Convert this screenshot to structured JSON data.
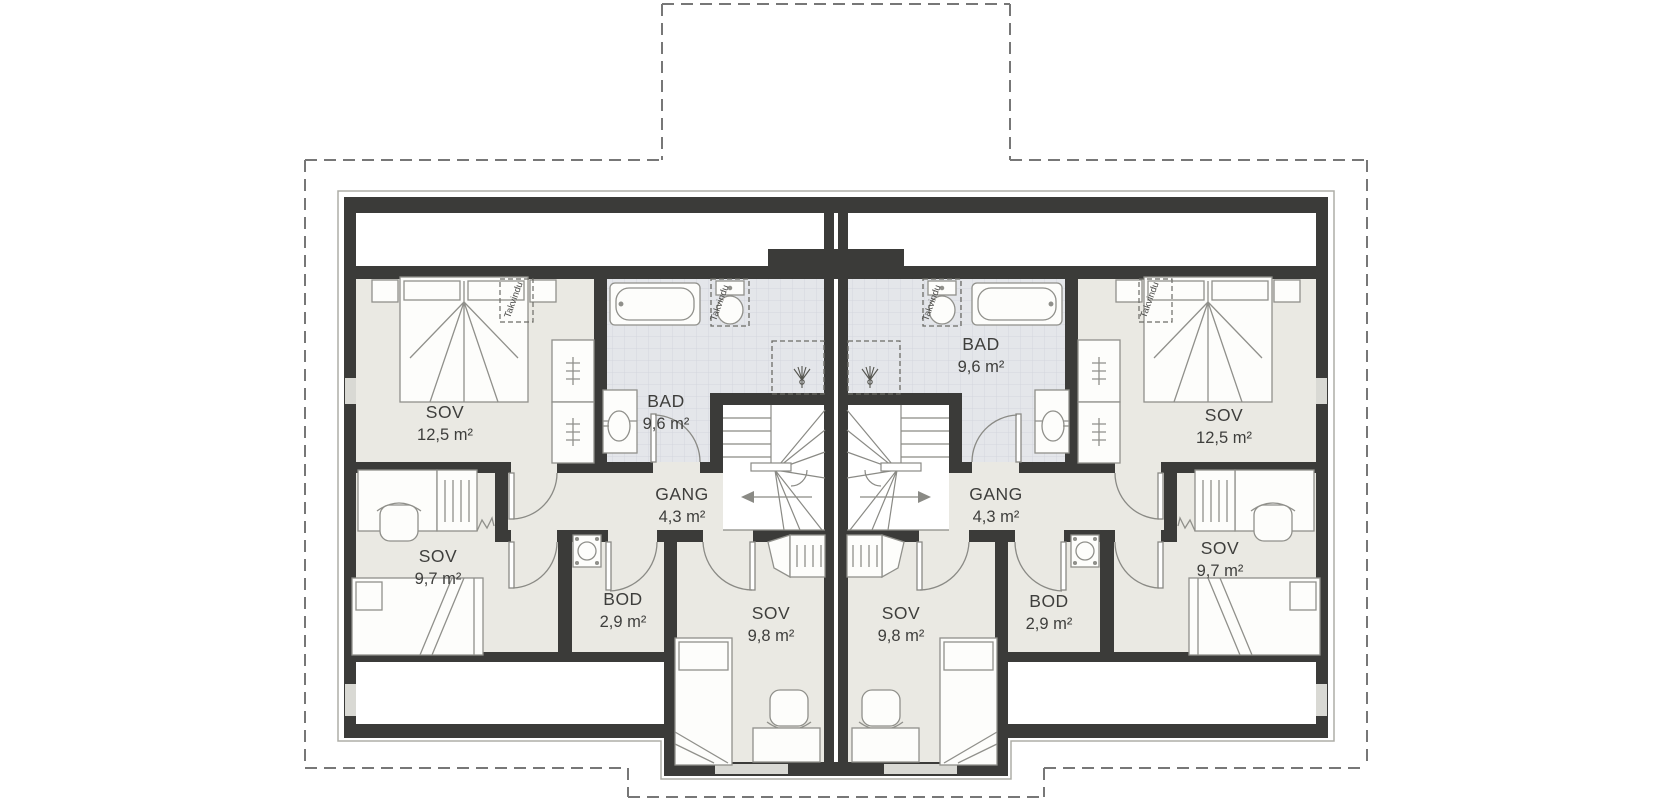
{
  "floorplan": {
    "kind": "duplex-upper-floor-plan",
    "units": [
      {
        "name": "left-unit",
        "rooms": [
          {
            "name": "SOV",
            "area": "12,5 m²"
          },
          {
            "name": "BAD",
            "area": "9,6 m²"
          },
          {
            "name": "GANG",
            "area": "4,3 m²"
          },
          {
            "name": "SOV",
            "area": "9,7 m²"
          },
          {
            "name": "BOD",
            "area": "2,9 m²"
          },
          {
            "name": "SOV",
            "area": "9,8 m²"
          }
        ]
      },
      {
        "name": "right-unit",
        "rooms": [
          {
            "name": "SOV",
            "area": "12,5 m²"
          },
          {
            "name": "BAD",
            "area": "9,6 m²"
          },
          {
            "name": "GANG",
            "area": "4,3 m²"
          },
          {
            "name": "SOV",
            "area": "9,7 m²"
          },
          {
            "name": "BOD",
            "area": "2,9 m²"
          },
          {
            "name": "SOV",
            "area": "9,8 m²"
          }
        ]
      }
    ],
    "annotations": {
      "takvindu": "Takvindu"
    },
    "colors": {
      "wall": "#3b3b39",
      "floor": "#eae9e3",
      "bath_tile": "#e4e6ea",
      "tile_grid": "#d3d6dd",
      "outline": "#adada7",
      "dashed_line": "#777777",
      "furniture_stroke": "#90908b",
      "label_text": "#3e3e3c"
    }
  }
}
